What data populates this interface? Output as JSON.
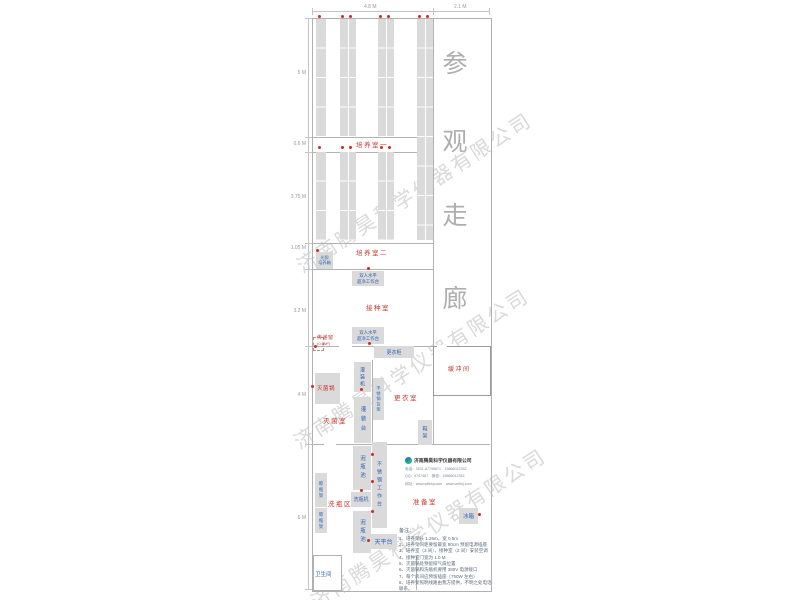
{
  "watermark": "济南腾昊科学仪器有限公司",
  "corridor": {
    "chars": [
      "参",
      "观",
      "走",
      "廊"
    ]
  },
  "dims": {
    "top_main": "4.8 M",
    "top_corridor": "2.1 M",
    "left": [
      "5 M",
      "0.6 M",
      "3.75 M",
      "1.05 M",
      "3.2 M",
      "4 M",
      "6 M"
    ]
  },
  "rooms": {
    "cultivation1": "培养室一",
    "cultivation2": "培养室二",
    "inoculation": "接种室",
    "sterilization": "灭菌室",
    "changing": "更衣室",
    "washing": "洗瓶区",
    "preparation": "准备室",
    "buffer": "缓冲间",
    "toilet": "卫生间"
  },
  "equipment": {
    "light_incubator_lines": [
      "光照",
      "培养箱"
    ],
    "clean_bench_lines": [
      "双人水平",
      "超净工作台"
    ],
    "wardrobe": "更衣柜",
    "filling_machine": "灌装机",
    "ss_shelf": "不锈钢货架",
    "filling_table": "灌装台",
    "sterilizer": "灭菌锅",
    "shoe_rack": "鞋架",
    "soak_pool": "泡瓶池",
    "ss_worktable": "不锈钢工作台",
    "bottle_washer": "洗瓶机",
    "balance_table": "天平台",
    "dry_rack": "晾瓶架",
    "fridge": "冰箱"
  },
  "pass_window": {
    "label": "传递窗",
    "size": "(0.6M²)"
  },
  "company": {
    "name": "济南腾昊科学仪器有限公司",
    "line_phone": "电话：0531-87796671　15866012352",
    "line_qq": "QQ：9747467　微信：15866012352",
    "line_web": "网址：www.sdthky.com　www.cnthkj.com"
  },
  "notes": {
    "title": "备注：",
    "items": [
      "1、培养架长 1.25m，宽 0.5m",
      "2、培养架间距要留最宽 80cm 预留电源插座",
      "3、培养室（3 间）、接种室（2 间）安装空调",
      "4、接种室门宽为 1.0 M",
      "5、灭菌锅处预留排气扇位置",
      "6、灭菌锅和洗瓶机要用 380V 电源接口",
      "7、每个房间应预留插座（750W 左右）",
      "8、培养架照明线路由我方提供，不明之处电话联系。"
    ]
  }
}
